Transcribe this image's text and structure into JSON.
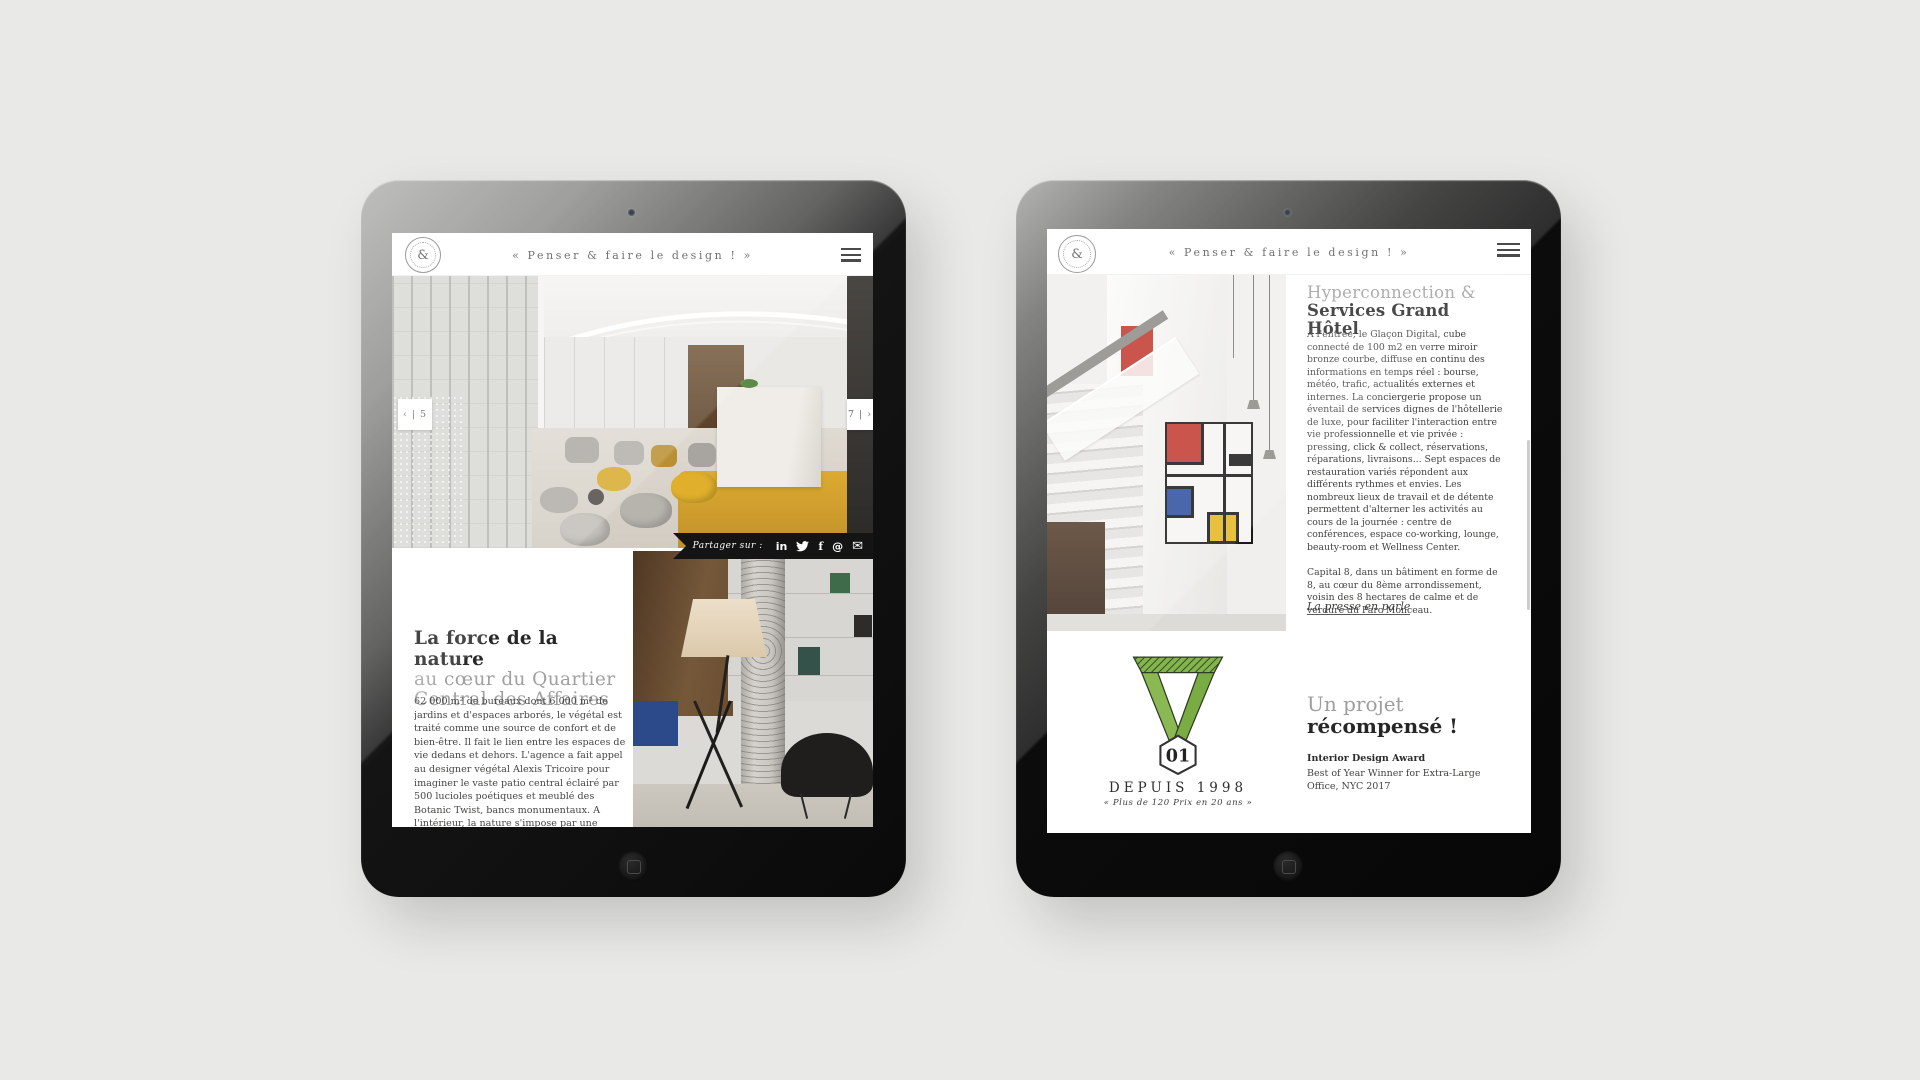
{
  "site": {
    "tagline": "« Penser & faire le design ! »",
    "logo_char": "&"
  },
  "left_page": {
    "pager_prev": "‹ | 5",
    "pager_next": "7 | ›",
    "share": {
      "label": "Partager sur :",
      "icons": [
        {
          "name": "linkedin-icon",
          "glyph": "in"
        },
        {
          "name": "twitter-icon",
          "glyph": "twitter-bird-shape"
        },
        {
          "name": "facebook-icon",
          "glyph": "f"
        },
        {
          "name": "at-icon",
          "glyph": "@"
        },
        {
          "name": "mail-icon",
          "glyph": "✉"
        }
      ]
    },
    "article": {
      "title_bold": "La force de la nature",
      "title_light_1": "au cœur du Quartier",
      "title_light_2": "Central des Affaires",
      "body": "62 000 m² de bureaux dont 6 000 m² de jardins et d'espaces arborés, le végétal est traité comme une source de confort et de bien-être. Il fait le lien entre les espaces de vie dedans et dehors. L'agence a fait appel au designer végétal Alexis Tricoire pour imaginer le vaste patio central éclairé par 500 lucioles poétiques et meublé des Botanic Twist, bancs monumentaux. A l'intérieur, la nature s'impose par une palette de couleurs, inspirées du Parc Monceau tout proche : vert mousse, vert lichen, vert fougère, jaune bouton d'or, brun noisette, taupe, et gris minéral."
    }
  },
  "right_page": {
    "article": {
      "title_light": "Hyperconnection &",
      "title_bold": "Services Grand Hôtel",
      "paragraphs": [
        "À l'entrée, le Glaçon Digital, cube connecté de 100 m2 en verre miroir bronze courbe, diffuse en continu des informations en temps réel : bourse, météo, trafic, actualités externes et internes.  La conciergerie propose un éventail de services dignes de l'hôtellerie de luxe, pour faciliter l'interaction entre vie professionnelle et vie privée : pressing, click & collect, réservations, réparations, livraisons... Sept espaces de restauration variés répondent aux différents rythmes et envies. Les nombreux lieux de travail et de détente permettent d'alterner les activités au cours de la journée : centre de conférences, espace co-working, lounge, beauty-room et Wellness Center.",
        "Capital 8, dans un bâtiment en forme de 8, au cœur du 8ème arrondissement, voisin des 8 hectares de calme et de verdure du Parc Monceau."
      ],
      "press_link": "La presse en parle"
    },
    "award": {
      "medal_number": "01",
      "since": "DEPUIS 1998",
      "tagline": "« Plus de 120 Prix en 20 ans »",
      "title_light": "Un projet",
      "title_bold": "récompensé !",
      "award_name": "Interior Design Award",
      "award_desc": "Best of Year Winner for Extra-Large Office, NYC 2017"
    }
  },
  "colors": {
    "canvas_bg": "#e9e9e7",
    "ribbon_black": "#141414",
    "medal_green": "#82b54b",
    "medal_outline": "#2f3b22",
    "accent_yellow": "#d7a62e"
  }
}
